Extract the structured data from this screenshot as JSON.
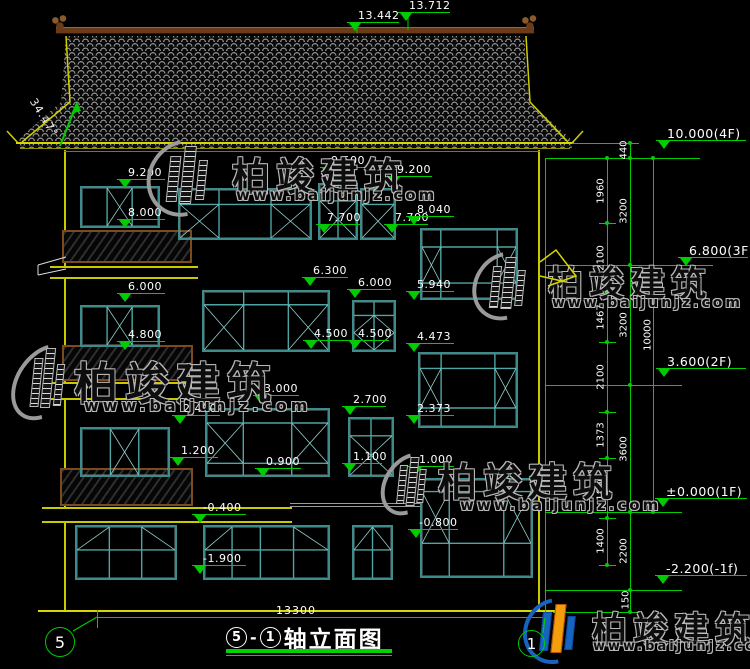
{
  "title": {
    "axis_start": "5",
    "axis_end": "1",
    "text": "轴立面图"
  },
  "axis_bubbles": {
    "left": "5",
    "right": "1"
  },
  "roof": {
    "angle_label": "34.47°"
  },
  "ridge_markers": [
    {
      "label": "13.442",
      "x": 347,
      "y": 10,
      "w": 52
    },
    {
      "label": "13.712",
      "x": 398,
      "y": 0,
      "w": 52
    }
  ],
  "elevation_markers": [
    {
      "label": "9.200",
      "x": 117,
      "y": 167,
      "w": 48
    },
    {
      "label": "8.000",
      "x": 117,
      "y": 207,
      "w": 48
    },
    {
      "label": "6.000",
      "x": 117,
      "y": 281,
      "w": 48
    },
    {
      "label": "4.800",
      "x": 117,
      "y": 329,
      "w": 48
    },
    {
      "label": "2.400",
      "x": 172,
      "y": 403,
      "w": 48
    },
    {
      "label": "1.200",
      "x": 170,
      "y": 445,
      "w": 48
    },
    {
      "label": "-0.400",
      "x": 192,
      "y": 502,
      "w": 54
    },
    {
      "label": "-1.900",
      "x": 192,
      "y": 553,
      "w": 54
    },
    {
      "label": "9.500",
      "x": 320,
      "y": 155,
      "w": 46
    },
    {
      "label": "9.200",
      "x": 386,
      "y": 164,
      "w": 46
    },
    {
      "label": "7.700",
      "x": 316,
      "y": 212,
      "w": 44
    },
    {
      "label": "7.700",
      "x": 384,
      "y": 212,
      "w": 44
    },
    {
      "label": "8.040",
      "x": 406,
      "y": 204,
      "w": 48
    },
    {
      "label": "5.940",
      "x": 406,
      "y": 279,
      "w": 48
    },
    {
      "label": "6.300",
      "x": 302,
      "y": 265,
      "w": 46
    },
    {
      "label": "6.000",
      "x": 347,
      "y": 277,
      "w": 44
    },
    {
      "label": "4.500",
      "x": 303,
      "y": 328,
      "w": 44
    },
    {
      "label": "4.500",
      "x": 347,
      "y": 328,
      "w": 42
    },
    {
      "label": "4.473",
      "x": 406,
      "y": 331,
      "w": 48
    },
    {
      "label": "2.373",
      "x": 406,
      "y": 403,
      "w": 48
    },
    {
      "label": "3.000",
      "x": 253,
      "y": 383,
      "w": 46
    },
    {
      "label": "0.900",
      "x": 255,
      "y": 456,
      "w": 46
    },
    {
      "label": "2.700",
      "x": 342,
      "y": 394,
      "w": 44
    },
    {
      "label": "1.100",
      "x": 342,
      "y": 451,
      "w": 40
    },
    {
      "label": "1.000",
      "x": 408,
      "y": 454,
      "w": 46
    },
    {
      "label": "-0.800",
      "x": 408,
      "y": 517,
      "w": 50
    }
  ],
  "level_markers": [
    {
      "label": "10.000(4F)",
      "x": 656,
      "y": 127,
      "w": 90
    },
    {
      "label": "6.800(3F)",
      "x": 678,
      "y": 244,
      "w": 70
    },
    {
      "label": "3.600(2F)",
      "x": 656,
      "y": 355,
      "w": 90
    },
    {
      "label": "±0.000(1F)",
      "x": 655,
      "y": 485,
      "w": 92
    },
    {
      "label": "-2.200(-1f)",
      "x": 655,
      "y": 562,
      "w": 92
    }
  ],
  "dim_chains": {
    "verticals": [
      [
        607,
        158,
        565
      ],
      [
        630,
        143,
        612
      ],
      [
        653,
        158,
        512
      ],
      [
        545,
        158,
        612
      ],
      [
        97,
        610,
        628
      ],
      [
        545,
        610,
        628
      ]
    ],
    "horizontals": [
      [
        545,
        158,
        700
      ],
      [
        572,
        143,
        633
      ],
      [
        545,
        265,
        713
      ],
      [
        545,
        385,
        682
      ],
      [
        545,
        512,
        682
      ],
      [
        545,
        590,
        682
      ],
      [
        553,
        612,
        640
      ],
      [
        97,
        617,
        545
      ]
    ],
    "ticks": [
      {
        "x": 599,
        "ys": [
          158,
          223,
          293,
          342,
          412,
          458,
          518,
          565
        ]
      },
      {
        "x": 622,
        "ys": [
          143,
          158,
          265,
          385,
          512,
          590,
          612
        ]
      },
      {
        "x": 645,
        "ys": [
          158,
          512
        ]
      }
    ],
    "labels": [
      {
        "text": "1960",
        "x": 601,
        "y": 191
      },
      {
        "text": "2100",
        "x": 601,
        "y": 258
      },
      {
        "text": "1467",
        "x": 601,
        "y": 317
      },
      {
        "text": "2100",
        "x": 601,
        "y": 377
      },
      {
        "text": "1373",
        "x": 601,
        "y": 435
      },
      {
        "text": "1800",
        "x": 601,
        "y": 488
      },
      {
        "text": "1400",
        "x": 601,
        "y": 541
      },
      {
        "text": "440",
        "x": 624,
        "y": 150
      },
      {
        "text": "3200",
        "x": 624,
        "y": 211
      },
      {
        "text": "3200",
        "x": 624,
        "y": 325
      },
      {
        "text": "3600",
        "x": 624,
        "y": 449
      },
      {
        "text": "2200",
        "x": 624,
        "y": 551
      },
      {
        "text": "150",
        "x": 626,
        "y": 600
      },
      {
        "text": "10000",
        "x": 648,
        "y": 335
      }
    ]
  },
  "bottom_dim": {
    "label": "13300",
    "x": 276,
    "y": 604
  },
  "windows": [
    {
      "x": 80,
      "y": 186,
      "w": 80,
      "h": 42,
      "v": [
        0.33,
        0.66
      ],
      "hl": [],
      "d": [
        [
          0.33,
          0,
          0.66,
          1
        ],
        [
          0.33,
          1,
          0.66,
          0
        ]
      ]
    },
    {
      "x": 178,
      "y": 188,
      "w": 134,
      "h": 52,
      "v": [
        0.3,
        0.7
      ],
      "hl": [
        0.3
      ],
      "d": [
        [
          0,
          0.3,
          0.3,
          1
        ],
        [
          0,
          1,
          0.3,
          0.3
        ],
        [
          0.7,
          0.3,
          1,
          1
        ],
        [
          0.7,
          1,
          1,
          0.3
        ]
      ]
    },
    {
      "x": 318,
      "y": 183,
      "w": 40,
      "h": 57,
      "v": [
        0.5
      ],
      "hl": [
        0.3
      ],
      "d": [
        [
          0,
          0.3,
          1,
          1
        ],
        [
          0,
          1,
          1,
          0.3
        ]
      ]
    },
    {
      "x": 360,
      "y": 188,
      "w": 36,
      "h": 52,
      "v": [],
      "hl": [
        0.3
      ],
      "d": [
        [
          0,
          0.3,
          1,
          1
        ],
        [
          0,
          1,
          1,
          0.3
        ]
      ]
    },
    {
      "x": 420,
      "y": 228,
      "w": 98,
      "h": 72,
      "v": [
        0.2,
        0.8
      ],
      "hl": [
        0.25,
        0.78
      ],
      "d": [
        [
          0,
          0.25,
          0.2,
          0.78
        ],
        [
          0,
          0.78,
          0.2,
          0.25
        ],
        [
          0.8,
          0.25,
          1,
          0.78
        ],
        [
          0.8,
          0.78,
          1,
          0.25
        ]
      ]
    },
    {
      "x": 80,
      "y": 305,
      "w": 80,
      "h": 42,
      "v": [
        0.33,
        0.66
      ],
      "hl": [],
      "d": [
        [
          0.33,
          0,
          0.66,
          1
        ],
        [
          0.33,
          1,
          0.66,
          0
        ]
      ]
    },
    {
      "x": 202,
      "y": 290,
      "w": 128,
      "h": 62,
      "v": [
        0.32,
        0.68
      ],
      "hl": [
        0.22
      ],
      "d": [
        [
          0,
          0.22,
          0.32,
          1
        ],
        [
          0,
          1,
          0.32,
          0.22
        ],
        [
          0.68,
          0.22,
          1,
          1
        ],
        [
          0.68,
          1,
          1,
          0.22
        ]
      ]
    },
    {
      "x": 352,
      "y": 300,
      "w": 44,
      "h": 52,
      "v": [
        0.5
      ],
      "hl": [
        0.28
      ],
      "d": [
        [
          0,
          0.64,
          0.5,
          0.28
        ],
        [
          0.5,
          0.28,
          1,
          0.64
        ],
        [
          1,
          0.64,
          0.5,
          1
        ],
        [
          0.5,
          1,
          0,
          0.64
        ]
      ]
    },
    {
      "x": 418,
      "y": 352,
      "w": 100,
      "h": 76,
      "v": [
        0.22,
        0.78
      ],
      "hl": [
        0.2,
        0.75
      ],
      "d": [
        [
          0,
          0.2,
          0.22,
          0.75
        ],
        [
          0,
          0.75,
          0.22,
          0.2
        ],
        [
          0.78,
          0.2,
          1,
          0.75
        ],
        [
          0.78,
          0.75,
          1,
          0.2
        ]
      ]
    },
    {
      "x": 80,
      "y": 427,
      "w": 90,
      "h": 50,
      "v": [
        0.33,
        0.66
      ],
      "hl": [],
      "d": [
        [
          0.33,
          0,
          0.66,
          1
        ],
        [
          0.33,
          1,
          0.66,
          0
        ]
      ]
    },
    {
      "x": 205,
      "y": 408,
      "w": 125,
      "h": 69,
      "v": [
        0.3,
        0.7
      ],
      "hl": [
        0.2,
        0.82
      ],
      "d": [
        [
          0,
          0.2,
          0.3,
          0.82
        ],
        [
          0,
          0.82,
          0.3,
          0.2
        ],
        [
          0.7,
          0.2,
          1,
          0.82
        ],
        [
          0.7,
          0.82,
          1,
          0.2
        ]
      ]
    },
    {
      "x": 348,
      "y": 417,
      "w": 46,
      "h": 60,
      "v": [
        0.5
      ],
      "hl": [
        0.3
      ],
      "d": [
        [
          0,
          0.3,
          1,
          1
        ],
        [
          0,
          1,
          1,
          0.3
        ]
      ]
    },
    {
      "x": 420,
      "y": 478,
      "w": 113,
      "h": 100,
      "v": [
        0.25,
        0.75
      ],
      "hl": [
        0.12,
        0.66
      ],
      "d": [
        [
          0,
          0.12,
          0.25,
          0.66
        ],
        [
          0,
          0.66,
          0.25,
          0.12
        ],
        [
          0.75,
          0.12,
          1,
          0.66
        ],
        [
          0.75,
          0.66,
          1,
          0.12
        ]
      ]
    },
    {
      "x": 75,
      "y": 525,
      "w": 102,
      "h": 55,
      "v": [
        0.33,
        0.66
      ],
      "hl": [
        0.45
      ],
      "d": [
        [
          0,
          0.45,
          0.33,
          0
        ],
        [
          0.66,
          0,
          1,
          0.45
        ]
      ]
    },
    {
      "x": 203,
      "y": 525,
      "w": 127,
      "h": 55,
      "v": [
        0.22,
        0.45,
        0.72
      ],
      "hl": [
        0.45
      ],
      "d": [
        [
          0,
          0.45,
          0.22,
          0
        ],
        [
          0.72,
          0,
          1,
          0.45
        ]
      ]
    },
    {
      "x": 352,
      "y": 525,
      "w": 41,
      "h": 55,
      "v": [
        0.5
      ],
      "hl": [
        0.45
      ],
      "d": [
        [
          0,
          0.45,
          0.5,
          0
        ],
        [
          0.5,
          0,
          1,
          0.45
        ]
      ]
    }
  ],
  "balconies": [
    [
      62,
      230,
      130,
      33
    ],
    [
      62,
      345,
      131,
      36
    ],
    [
      60,
      468,
      133,
      38
    ]
  ],
  "slabs": [
    [
      50,
      266,
      148,
      13
    ],
    [
      50,
      382,
      148,
      18
    ],
    [
      42,
      507,
      250,
      16
    ]
  ],
  "grey_lines": [
    [
      290,
      503,
      130
    ],
    [
      290,
      506,
      130
    ]
  ],
  "watermark": {
    "text": "柏竣建筑",
    "url": "www.baijunjz.com"
  },
  "watermarks": [
    {
      "x": 148,
      "y": 138,
      "lw": 72,
      "lh": 80,
      "tx": 232,
      "ty": 146,
      "ts": 38,
      "ux": 236,
      "uy": 186,
      "us": 15,
      "colored": false
    },
    {
      "x": 474,
      "y": 250,
      "lw": 62,
      "lh": 72,
      "tx": 548,
      "ty": 256,
      "ts": 35,
      "ux": 552,
      "uy": 295,
      "us": 14,
      "colored": false
    },
    {
      "x": 16,
      "y": 340,
      "lw": 58,
      "lh": 84,
      "tx": 74,
      "ty": 348,
      "ts": 44,
      "ux": 84,
      "uy": 396,
      "us": 16,
      "colored": false
    },
    {
      "x": 384,
      "y": 450,
      "lw": 50,
      "lh": 68,
      "tx": 438,
      "ty": 452,
      "ts": 39,
      "ux": 460,
      "uy": 496,
      "us": 15,
      "colored": false
    },
    {
      "x": 524,
      "y": 597,
      "lw": 62,
      "lh": 68,
      "tx": 592,
      "ty": 602,
      "ts": 35,
      "ux": 593,
      "uy": 639,
      "us": 13,
      "colored": true
    }
  ],
  "colors": {
    "dim_green": "#00cc00",
    "frame_teal": "#3d8c8c",
    "eave_yellow": "#d6d600",
    "ridge_brown": "#6b3a16",
    "logo_blue": "#1565c0",
    "logo_orange": "#f59e0b"
  }
}
